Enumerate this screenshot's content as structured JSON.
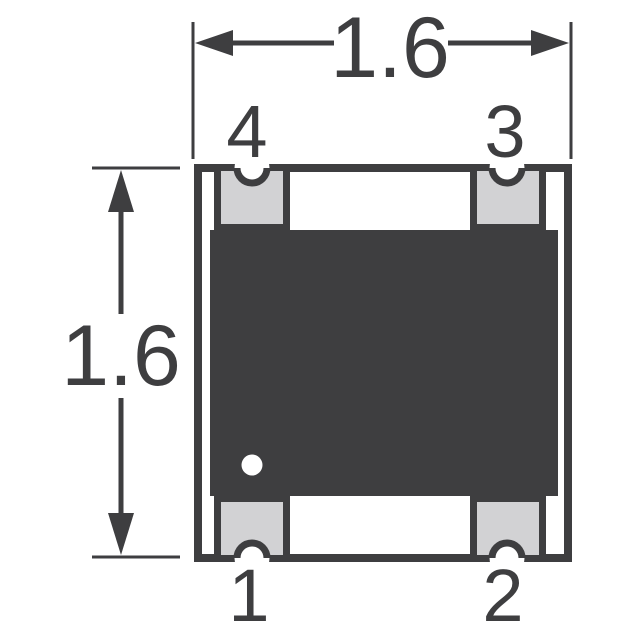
{
  "figure": {
    "title": "package-outline-top-view",
    "dimensions": {
      "width_label": "1.6",
      "height_label": "1.6"
    },
    "pins": [
      {
        "number": "1",
        "position": "bottom-left"
      },
      {
        "number": "2",
        "position": "bottom-right"
      },
      {
        "number": "3",
        "position": "top-right"
      },
      {
        "number": "4",
        "position": "top-left"
      }
    ],
    "colors": {
      "line_dark": "#3e3e40",
      "pad_gray": "#d2d2d4",
      "background": "#ffffff"
    }
  }
}
